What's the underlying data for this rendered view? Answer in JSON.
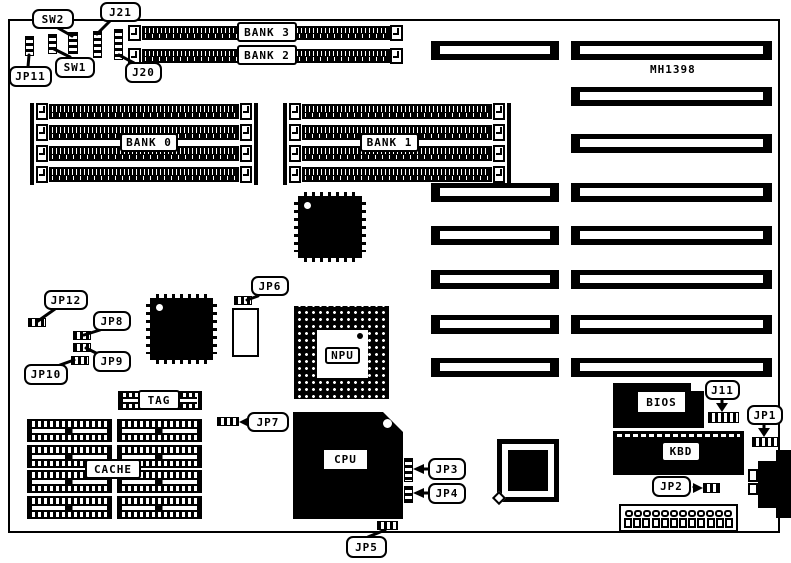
{
  "board": {
    "model": "MH1398"
  },
  "labels": {
    "sw2": "SW2",
    "sw1": "SW1",
    "j21": "J21",
    "j20": "J20",
    "jp11": "JP11",
    "bank3": "BANK 3",
    "bank2": "BANK 2",
    "bank0": "BANK 0",
    "bank1": "BANK 1",
    "jp6": "JP6",
    "jp12": "JP12",
    "jp8": "JP8",
    "jp9": "JP9",
    "jp10": "JP10",
    "npu": "NPU",
    "tag": "TAG",
    "cache": "CACHE",
    "jp7": "JP7",
    "cpu": "CPU",
    "jp3": "JP3",
    "jp4": "JP4",
    "jp5": "JP5",
    "bios": "BIOS",
    "j11": "J11",
    "jp1": "JP1",
    "kbd": "KBD",
    "jp2": "JP2"
  },
  "power_connector": {
    "top_pins": 12,
    "bottom_pins": 12
  },
  "colors": {
    "ink": "#000000",
    "paper": "#ffffff"
  }
}
